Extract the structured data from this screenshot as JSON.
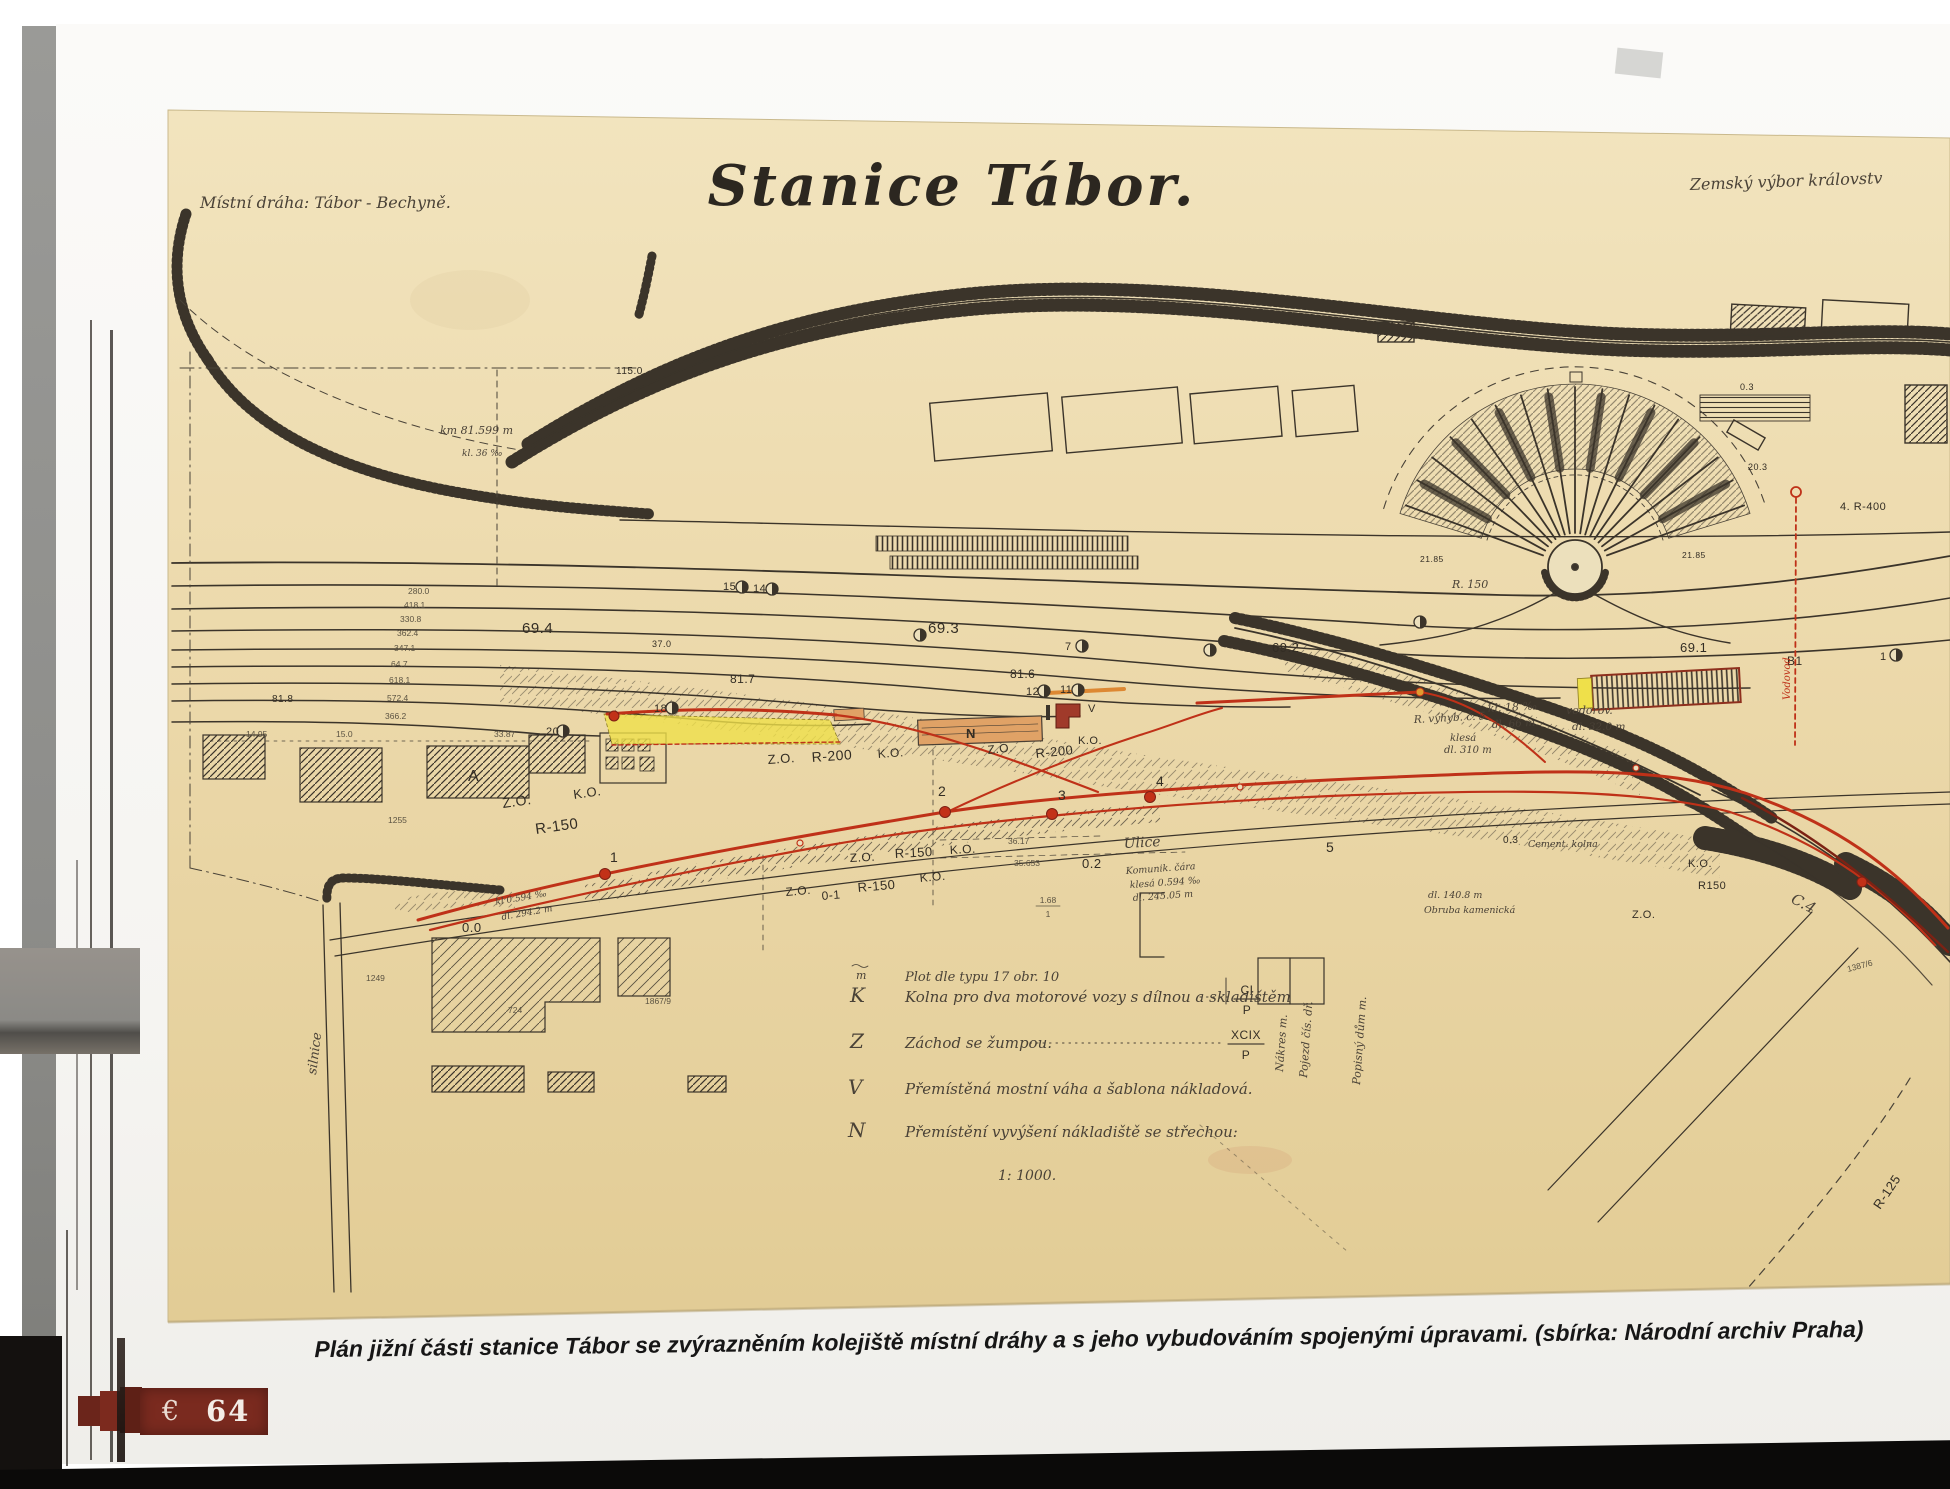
{
  "page": {
    "caption": "Plán jižní části stanice Tábor se zvýrazněním kolejiště místní dráhy a s jeho vybudováním spojenými úpravami. (sbírka: Národní archiv Praha)",
    "page_glyph": "€",
    "page_number": "64"
  },
  "plan": {
    "title": "Stanice Tábor.",
    "top_left_note": "Místní dráha: Tábor - Bechyně.",
    "top_right_note": "Zemský výbor královstv",
    "scale": "1: 1000.",
    "legend": {
      "fence_symbol": "m",
      "fence_text": "Plot dle typu 17 obr. 10",
      "k_letter": "K",
      "k_text": "Kolna pro dva motorové vozy s dílnou a skladištěm",
      "k_ref_top": "CI",
      "k_ref_bottom": "P",
      "z_letter": "Z",
      "z_text": "Záchod se žumpou.",
      "z_ref_top": "XCIX",
      "z_ref_bottom": "P",
      "v_letter": "V",
      "v_text": "Přemístěná mostní váha a šablona nákladová.",
      "n_letter": "N",
      "n_text": "Přemístění vyvýšení nákladiště se střechou:"
    },
    "tracks": {
      "t694": "69.4",
      "t370": "37.0",
      "t817": "81.7",
      "t693": "69.3",
      "t816": "81.6",
      "t692": "69.2",
      "t691": "69.1",
      "b1": "B1",
      "t818": "81.8",
      "t1150": "115.0",
      "r400": "4. R-400",
      "t203": "20.3",
      "t03a": "0.3",
      "t03b": "0.3",
      "t2185a": "21.85",
      "t2185b": "21.85",
      "r150fan": "R. 150"
    },
    "chainage": {
      "c1": "280.0",
      "c2": "418.1",
      "c3": "330.8",
      "c4": "362.4",
      "c5": "347.1",
      "c6": "64.7",
      "c7": "618.1",
      "c8": "572.4",
      "c9": "366.2"
    },
    "switches": {
      "s20": "20",
      "s18": "18",
      "s15": "15",
      "s14": "14",
      "s12": "12",
      "s11": "11",
      "s7": "7",
      "s1": "1"
    },
    "red_points": {
      "d1": "1",
      "d2": "2",
      "d3": "3",
      "d4": "4",
      "d5": "5"
    },
    "geometry": {
      "zo": "Z.O.",
      "ko": "K.O.",
      "r200": "R-200",
      "r150": "R-150",
      "r150s": "R150",
      "o01": "0-1",
      "o0": "0.0",
      "o2": "0.2",
      "o3": "0.3",
      "c4": "C.4",
      "r125": "R-125"
    },
    "buildings": {
      "a": "A",
      "n": "N",
      "v": "V"
    },
    "dims": {
      "d1": "14.95",
      "d2": "15.0",
      "d3": "33.87",
      "f_top": "1.68",
      "f_bottom": "1",
      "m1": "35.653",
      "m2": "36.17"
    },
    "parcels": {
      "p1": "1255",
      "p2": "1249",
      "p3": "724",
      "p4": "1867/9",
      "p5": "1387/6"
    },
    "street": {
      "ulice": "Ulice",
      "five": "5",
      "silnice": "silnice"
    },
    "notes": {
      "km": "km 81.599 m",
      "kl36": "kl. 36 ‰",
      "n1": "R. výhyb. č. 5",
      "n2": "kl. 18 ‰",
      "n3": "dl. 66 m",
      "n4": "vodorov.",
      "n5": "dl. 32.0 m",
      "n6": "klesá",
      "n7": "dl. 310 m",
      "n8": "Komunik. čára",
      "n9": "klesá 0.594 ‰",
      "n10": "dl. 245.05 m",
      "n11": "dl. 140.8 m",
      "n12": "Obruba kamenická",
      "n13": "Cement. kolna",
      "n14": "kl 0.594 ‰",
      "n15": "dl. 294.2 m",
      "vod": "Vodovod",
      "v1": "Pojezd čís. dř.",
      "v2": "Popisný dům m.",
      "v3": "Nákres m."
    },
    "colors": {
      "paper": "#ecd9ab",
      "ink": "#3b342a",
      "red": "#bf3118",
      "yellow": "#efe04a",
      "orange": "#e0a266",
      "banner": "#7a2a1f"
    }
  }
}
